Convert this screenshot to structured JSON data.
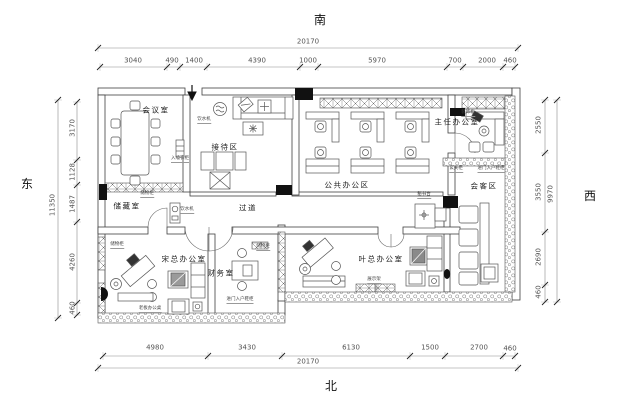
{
  "compass": {
    "south": "南",
    "north": "北",
    "east": "东",
    "west": "西"
  },
  "dimensions": {
    "top": {
      "total": "20170",
      "segments": [
        "3040",
        "490",
        "1400",
        "4390",
        "1000",
        "5970",
        "700",
        "2000",
        "460"
      ]
    },
    "bottom": {
      "total": "20170",
      "segments": [
        "4980",
        "3430",
        "6130",
        "1500",
        "2700",
        "460"
      ]
    },
    "left": {
      "total": "11350",
      "segments": [
        "3170",
        "1128",
        "1487",
        "4260",
        "460"
      ]
    },
    "right": {
      "total": "9970",
      "segments": [
        "2550",
        "3550",
        "2690",
        "460"
      ]
    }
  },
  "rooms": {
    "meeting": "会议室",
    "reception": "接待区",
    "open_office": "公共办公区",
    "director": "主任办公室",
    "storage": "储藏室",
    "corridor": "过道",
    "guest": "会客区",
    "boss_song": "宋总办公室",
    "finance": "财务室",
    "boss_ye": "叶总办公室"
  },
  "annotations": {
    "wardrobe": "入墙衣柜",
    "cabinet": "储物柜",
    "water": "饮水机",
    "deco_cabinet": "装饰柜",
    "entry_cabinet": "玄关柜",
    "entry_shoe": "进门入户鞋柜",
    "secretary_desk": "秘书台",
    "display_rack": "展示架",
    "boss_desk": "老板办公桌"
  }
}
